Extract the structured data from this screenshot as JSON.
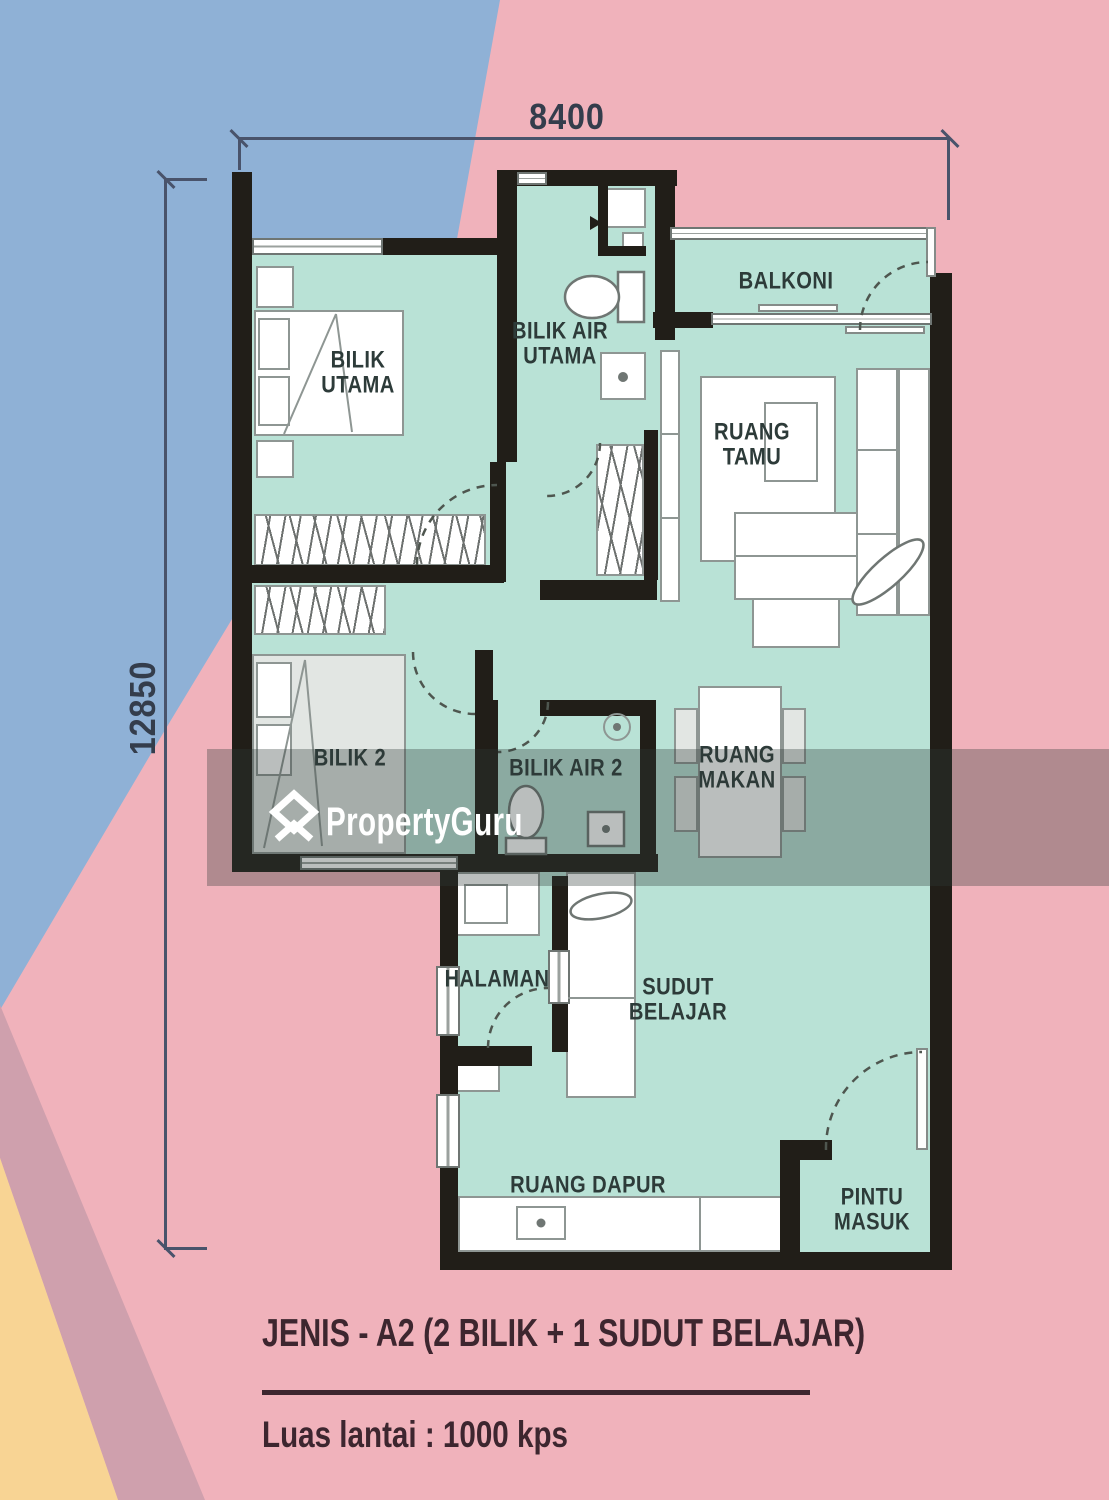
{
  "dimensions": {
    "width_label": "8400",
    "height_label": "12850"
  },
  "rooms": [
    {
      "id": "bilik-utama",
      "lines": [
        "BILIK",
        "UTAMA"
      ]
    },
    {
      "id": "bilik-air-utama",
      "lines": [
        "BILIK AIR",
        "UTAMA"
      ]
    },
    {
      "id": "balkoni",
      "lines": [
        "BALKONI"
      ]
    },
    {
      "id": "ruang-tamu",
      "lines": [
        "RUANG",
        "TAMU"
      ]
    },
    {
      "id": "bilik-2",
      "lines": [
        "BILIK 2"
      ]
    },
    {
      "id": "bilik-air-2",
      "lines": [
        "BILIK AIR 2"
      ]
    },
    {
      "id": "ruang-makan",
      "lines": [
        "RUANG",
        "MAKAN"
      ]
    },
    {
      "id": "halaman",
      "lines": [
        "HALAMAN"
      ]
    },
    {
      "id": "sudut-belajar",
      "lines": [
        "SUDUT",
        "BELAJAR"
      ]
    },
    {
      "id": "ruang-dapur",
      "lines": [
        "RUANG DAPUR"
      ]
    },
    {
      "id": "pintu-masuk",
      "lines": [
        "PINTU",
        "MASUK"
      ]
    }
  ],
  "watermark": {
    "brand": "PropertyGuru"
  },
  "caption": {
    "unit_type": "JENIS - A2",
    "unit_detail": " (2 BILIK + 1 SUDUT BELAJAR)",
    "floor_area": "Luas lantai : 1000 kps"
  },
  "colors": {
    "background_blue": "#8fb1d6",
    "background_pink": "#f0b2bb",
    "background_mauve": "#cfa0ad",
    "background_yellow": "#f8d494",
    "floor_mint": "#b9e2d6",
    "wall_black": "#211e18",
    "label_text": "#2d3b39",
    "dimension_text": "#343d4c",
    "caption_text": "#3d262f",
    "watermark_overlay": "rgba(45,57,54,0.33)",
    "watermark_text": "#ffffff"
  }
}
